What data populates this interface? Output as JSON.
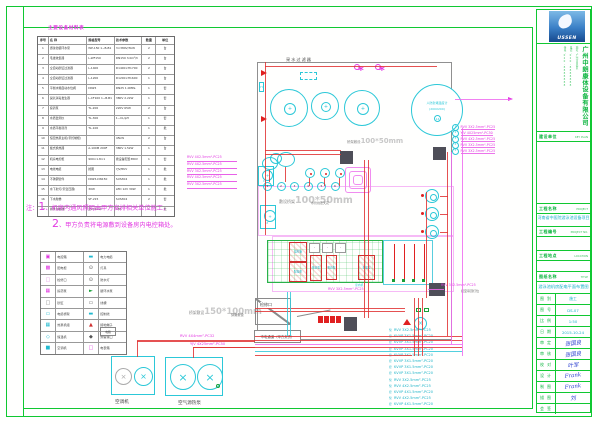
{
  "colors": {
    "frame_green": "#10c832",
    "magenta": "#e23ae2",
    "cyan": "#2cc8d8",
    "red": "#e02020",
    "gray_label": "#c8c8c8",
    "signature_blue": "#2b3fd0",
    "logo_blue": "#3a7fc6",
    "title_green": "#0bb43e"
  },
  "equipment_table": {
    "title": "主要设备材料表",
    "headers": [
      "序号",
      "名 称",
      "规格型号",
      "技术参数",
      "数量",
      "单位"
    ],
    "rows": [
      [
        "1",
        "游泳池循环水泵",
        "WP-150 1~B-B1",
        "3×380V/3kW",
        "2",
        "台"
      ],
      [
        "2",
        "毛发收集器",
        "L-WF150",
        "DN150 3.0m³/h",
        "2",
        "台"
      ],
      [
        "3",
        "全自动砂缸过滤器",
        "L-1400",
        "D1400×H1700",
        "2",
        "台"
      ],
      [
        "4",
        "全自动砂缸过滤器",
        "L-1200",
        "D1200×H1600",
        "1",
        "台"
      ],
      [
        "5",
        "平衡水箱自动水位阀",
        "DN25",
        "DN25 1.0MPa",
        "1",
        "套"
      ],
      [
        "6",
        "臭氧消毒发生器",
        "L-CF100 1~B-B1",
        "380V 2.2kW",
        "1",
        "套"
      ],
      [
        "7",
        "投药泵",
        "TL-200",
        "220V 65W",
        "2",
        "台"
      ],
      [
        "8",
        "水质监测仪",
        "TL-300",
        "1~CL/pH",
        "1",
        "套"
      ],
      [
        "9",
        "水质平衡药剂",
        "TL-100",
        "",
        "1",
        "批"
      ],
      [
        "10",
        "恒温热泵主机(带控制柜)",
        "",
        "45kW",
        "2",
        "台"
      ],
      [
        "11",
        "板式换热器",
        "A-100M 200F",
        "380V 1.5kW",
        "1",
        "台"
      ],
      [
        "12",
        "机房电控柜",
        "900×1.8×1",
        "按设备配置380V",
        "1",
        "套"
      ],
      [
        "13",
        "电线电缆",
        "按图",
        "YJV/RVV",
        "1",
        "批"
      ],
      [
        "14",
        "不锈钢管件",
        "DN25-DN150",
        "SUS304",
        "1",
        "批"
      ],
      [
        "15",
        "水下射灯(带变压器)",
        "30W",
        "LED 12V 30W",
        "1",
        "批"
      ],
      [
        "16",
        "下水爬梯",
        "SF-215",
        "SUS304",
        "2",
        "套"
      ],
      [
        "17",
        "排水沟格栅",
        "宽200mm",
        "ABS",
        "1",
        "批"
      ]
    ]
  },
  "notes": {
    "label": "注：",
    "items": [
      {
        "num": "1",
        "text": "、机房内通风照明由甲方安排相关单位施工，"
      },
      {
        "num": "2",
        "text": "、甲方负责将电源敷到设备房内电控箱处。"
      }
    ]
  },
  "legend": {
    "rows": [
      {
        "s1": "▣",
        "c1": "#dd33dd",
        "n1": "电控箱",
        "s2": "▬",
        "c2": "#22b9cf",
        "n2": "电力电缆"
      },
      {
        "s1": "▩",
        "c1": "#dd33dd",
        "n1": "配电柜",
        "s2": "⊙",
        "c2": "#555555",
        "n2": "灯具"
      },
      {
        "s1": "□",
        "c1": "#dd88dd",
        "n1": "检修口",
        "s2": "⊙",
        "c2": "#555555",
        "n2": "防水灯"
      },
      {
        "s1": "▦",
        "c1": "#dd33dd",
        "n1": "投药泵",
        "s2": "►",
        "c2": "#18a038",
        "n2": "循环水泵"
      },
      {
        "s1": "□",
        "c1": "#777777",
        "n1": "砂缸",
        "s2": "▭",
        "c2": "#555555",
        "n2": "线槽"
      },
      {
        "s1": "▭",
        "c1": "#22b9cf",
        "n1": "电缆桥架",
        "s2": "▬",
        "c2": "#22b9cf",
        "n2": "控制线"
      },
      {
        "s1": "▦",
        "c1": "#22b9cf",
        "n1": "热泵机组",
        "s2": "▲",
        "c2": "#d03030",
        "n2": "接地端子"
      },
      {
        "s1": "◇",
        "c1": "#22b9cf",
        "n1": "恒温机",
        "s2": "◆",
        "c2": "#555555",
        "n2": "预留接口"
      },
      {
        "s1": "■",
        "c1": "#22b9cf",
        "n1": "空调机",
        "s2": "□",
        "c2": "#dd33dd",
        "n2": "电表箱"
      }
    ]
  },
  "units": {
    "left_label": "空调机",
    "right_label": "空气源热泵",
    "cable1": "RVV 4X4mm²-PC32",
    "cable2": "YJV 4X25mm²-PC50",
    "meter_label": "电箱"
  },
  "drawing": {
    "top_label": "采水过滤器",
    "blast_line1": "人防封堵温度计",
    "blast_line2": "(200X200)",
    "blast_num": "14",
    "device_tag": "1P",
    "h_tag": "H",
    "tray_mid_prefix": "桥架敷设",
    "tray_mid_size": "100*50mm",
    "tray_big_prefix": "敷设桥架",
    "tray_big_size": "100*50mm",
    "ceiling_note": "水管线走天花",
    "tray_left_prefix": "桥架敷设",
    "tray_left_size": "150*100mm",
    "tray_left_note": "穿管敷设",
    "access_label": "检修口",
    "mains_label": "市电通道（甲方负责）",
    "indoor_label": "室内机",
    "grid_cable": "RVV 3X2.5mm²-PC25",
    "pool_cable": "RVV 3X2.5mm²-PC25",
    "pool_cable_note": "接至吊顶灯位",
    "grid_boxes": [
      "电控箱",
      "配电柜",
      "投药泵",
      "投药泵",
      "恒温泵"
    ],
    "grid_dashes": [
      "-",
      "-",
      "-"
    ],
    "plant_nums": [
      "1",
      "2",
      "3",
      "4",
      "5",
      "6"
    ],
    "left_cables": [
      "RVV 4X2.5mm²-PC25",
      "RVV 4X2.5mm²-PC25",
      "RVV 3X2.5mm²-PC25",
      "RVV 4X2.5mm²-PC25",
      "RVV 3X2.5mm²-PC25"
    ],
    "right_cables": [
      {
        "no": "1",
        "t": "RVV 3X2.5mm²-PC25"
      },
      {
        "no": "2",
        "t": "YJV 4X25mm²-PC50"
      },
      {
        "no": "3",
        "t": "RVV 4X2.5mm²-PC25"
      },
      {
        "no": "4",
        "t": "RVV 3X2.5mm²-PC25"
      },
      {
        "no": "5",
        "t": "RVV 3X2.5mm²-PC25"
      }
    ],
    "bottom_cables": [
      {
        "p": "泵",
        "t": "RVV 3X2.5mm²-PC25"
      },
      {
        "p": "控",
        "t": "KVVP 3X1.5mm²-PC20"
      },
      {
        "p": "控",
        "t": "KVVP 3X1.5mm²-PC20"
      },
      {
        "p": "控",
        "t": "KVVP 3X1.5mm²-PC20"
      },
      {
        "p": "控",
        "t": "KVVP 3X1.5mm²-PC20"
      },
      {
        "p": "控",
        "t": "KVVP 3X1.5mm²-PC20"
      },
      {
        "p": "控",
        "t": "KVVP 3X1.5mm²-PC20"
      },
      {
        "p": "控",
        "t": "KVVP 3X1.5mm²-PC20"
      },
      {
        "p": "泵",
        "t": "RVV 3X2.5mm²-PC25"
      },
      {
        "p": "泵",
        "t": "RVV 4X2.5mm²-PC25"
      },
      {
        "p": "控",
        "t": "KVVP 4X1.5mm²-PC20"
      },
      {
        "p": "泵",
        "t": "RVV 4X2.5mm²-PC25"
      },
      {
        "p": "控",
        "t": "KVVP 4X1.5mm²-PC20"
      }
    ]
  },
  "titleblock": {
    "logo_text": "USSEN",
    "company": "广州中朗康体设备有限公司",
    "company_info": [
      "地址：广州市白云区",
      "电话：020-8888888",
      "传真：020-8888888"
    ],
    "keyplan_label": "建设单位",
    "keyplan_en": "KEY PLAN",
    "project_label": "工程名称",
    "project_en": "PROJECT",
    "project_name": "河南省中医院游泳池设备项目",
    "no_label": "工程编号",
    "no_en": "PROJECT NO.",
    "loc_label": "工程地点",
    "loc_en": "LOCATION",
    "title_label": "图纸名称",
    "title_en": "TITLE",
    "drawing_title": "游泳池机房配电平面布置图",
    "info_rows": [
      {
        "label": "图 别",
        "value": "施工",
        "cls": "cyanv"
      },
      {
        "label": "图 号",
        "value": "DS-07",
        "cls": "cyanv"
      },
      {
        "label": "比 例",
        "value": "1:50",
        "cls": "cyanv"
      },
      {
        "label": "日 期",
        "value": "2015-10-24",
        "cls": "cyanv"
      },
      {
        "label": "审 定",
        "value": "张国良",
        "cls": "sig"
      },
      {
        "label": "审 核",
        "value": "张国良",
        "cls": "sig"
      },
      {
        "label": "校 对",
        "value": "叶军",
        "cls": "sig"
      },
      {
        "label": "设 计",
        "value": "Frank",
        "cls": "sig"
      },
      {
        "label": "制 图",
        "value": "Frank",
        "cls": "sig"
      },
      {
        "label": "描 图",
        "value": "刘",
        "cls": "sig"
      },
      {
        "label": "会 签",
        "value": "",
        "cls": "sig"
      }
    ]
  }
}
